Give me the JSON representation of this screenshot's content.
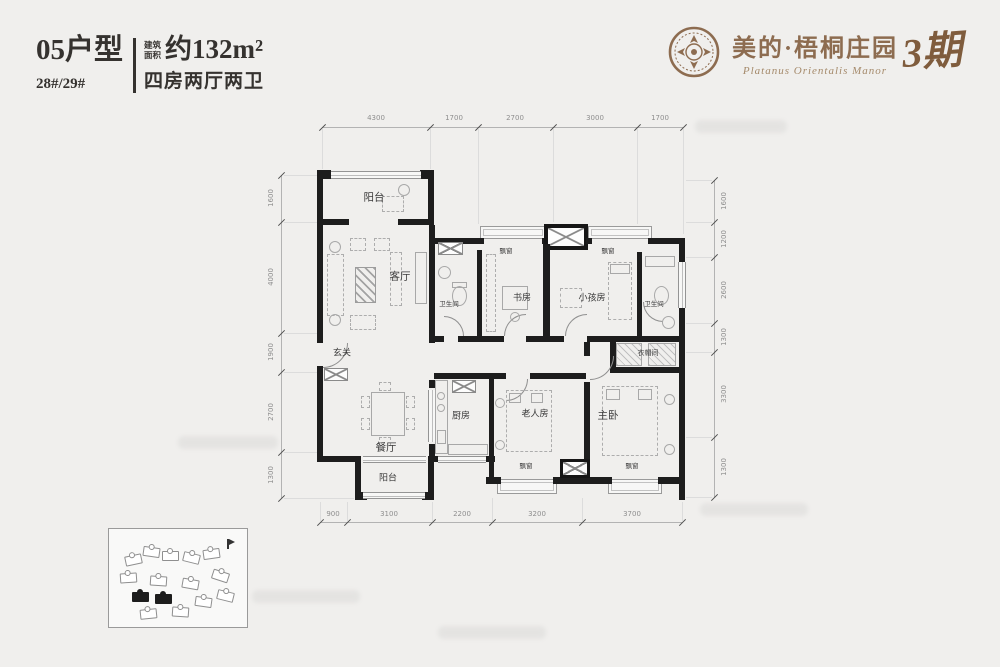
{
  "header": {
    "unit_type": "05户型",
    "buildings": "28#/29#",
    "area_label_line1": "建筑",
    "area_label_line2": "面积",
    "area_value": "约132m²",
    "layout_desc": "四房两厅两卫"
  },
  "brand": {
    "name_cn": "美的·梧桐庄园",
    "name_en": "Platanus Orientalis Manor",
    "phase": "3期",
    "accent_color": "#8d6c50",
    "emblem_icon": "ornate-circular-seal"
  },
  "floor_plan": {
    "rooms": [
      {
        "id": "balcony-top",
        "label": "阳台"
      },
      {
        "id": "living-room",
        "label": "客厅"
      },
      {
        "id": "entry-hall",
        "label": "玄关"
      },
      {
        "id": "dining-room",
        "label": "餐厅"
      },
      {
        "id": "balcony-bottom",
        "label": "阳台"
      },
      {
        "id": "kitchen",
        "label": "厨房"
      },
      {
        "id": "bathroom-1",
        "label": "卫生间"
      },
      {
        "id": "study",
        "label": "书房"
      },
      {
        "id": "kids-room",
        "label": "小孩房"
      },
      {
        "id": "bathroom-2",
        "label": "卫生间"
      },
      {
        "id": "walk-in-closet",
        "label": "衣帽间"
      },
      {
        "id": "elderly-room",
        "label": "老人房"
      },
      {
        "id": "master-bedroom",
        "label": "主卧"
      },
      {
        "id": "bay-window-top-left",
        "label": "飘窗"
      },
      {
        "id": "bay-window-top-right",
        "label": "飘窗"
      },
      {
        "id": "bay-window-bottom-left",
        "label": "飘窗"
      },
      {
        "id": "bay-window-bottom-right",
        "label": "飘窗"
      }
    ],
    "dimensions": {
      "top": [
        "4300",
        "1700",
        "2700",
        "3000",
        "1700"
      ],
      "bottom": [
        "900",
        "3100",
        "2200",
        "3200",
        "3700"
      ],
      "left": [
        "1600",
        "4000",
        "1900",
        "2700",
        "1300"
      ],
      "right": [
        "1600",
        "1200",
        "2600",
        "1300",
        "3300",
        "1300"
      ]
    }
  }
}
